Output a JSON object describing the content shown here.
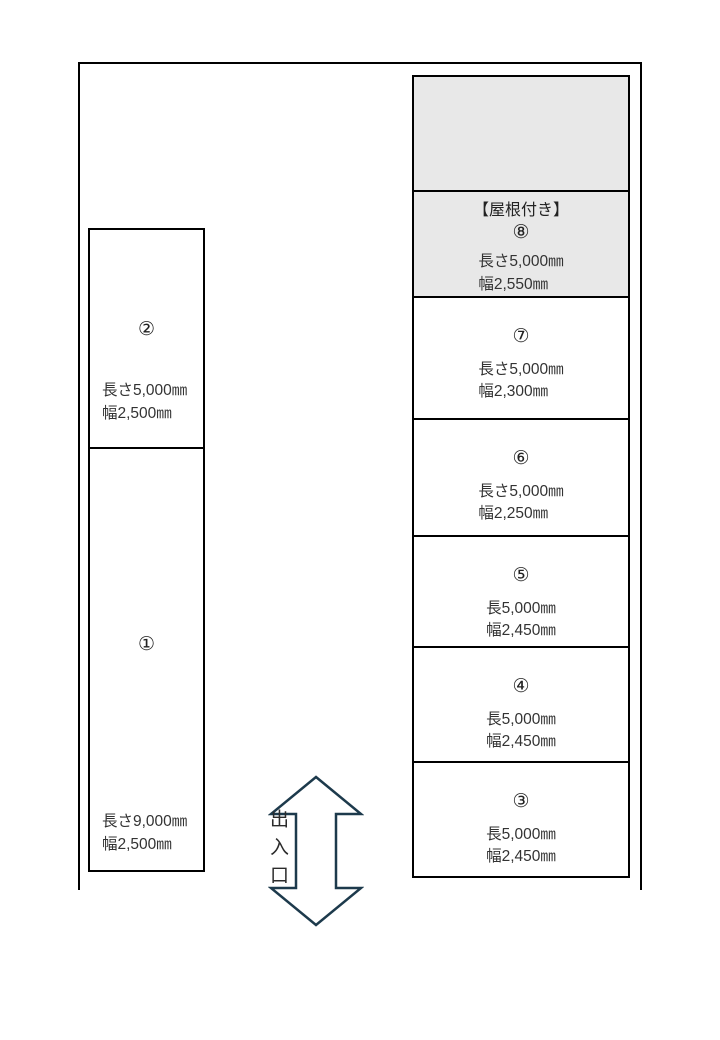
{
  "spaces": {
    "s1": {
      "number": "①",
      "length": "長さ9,000㎜",
      "width": "幅2,500㎜"
    },
    "s2": {
      "number": "②",
      "length": "長さ5,000㎜",
      "width": "幅2,500㎜"
    },
    "s3": {
      "number": "③",
      "length": "長5,000㎜",
      "width": "幅2,450㎜"
    },
    "s4": {
      "number": "④",
      "length": "長5,000㎜",
      "width": "幅2,450㎜"
    },
    "s5": {
      "number": "⑤",
      "length": "長5,000㎜",
      "width": "幅2,450㎜"
    },
    "s6": {
      "number": "⑥",
      "length": "長さ5,000㎜",
      "width": "幅2,250㎜"
    },
    "s7": {
      "number": "⑦",
      "length": "長さ5,000㎜",
      "width": "幅2,300㎜"
    },
    "s8": {
      "roof_label": "【屋根付き】",
      "number": "⑧",
      "length": "長さ5,000㎜",
      "width": "幅2,550㎜"
    }
  },
  "entrance": {
    "label": "出入口"
  },
  "colors": {
    "border": "#000000",
    "roofed_fill": "#e8e8e8",
    "arrow_stroke": "#1d3a4c",
    "text": "#333333"
  }
}
